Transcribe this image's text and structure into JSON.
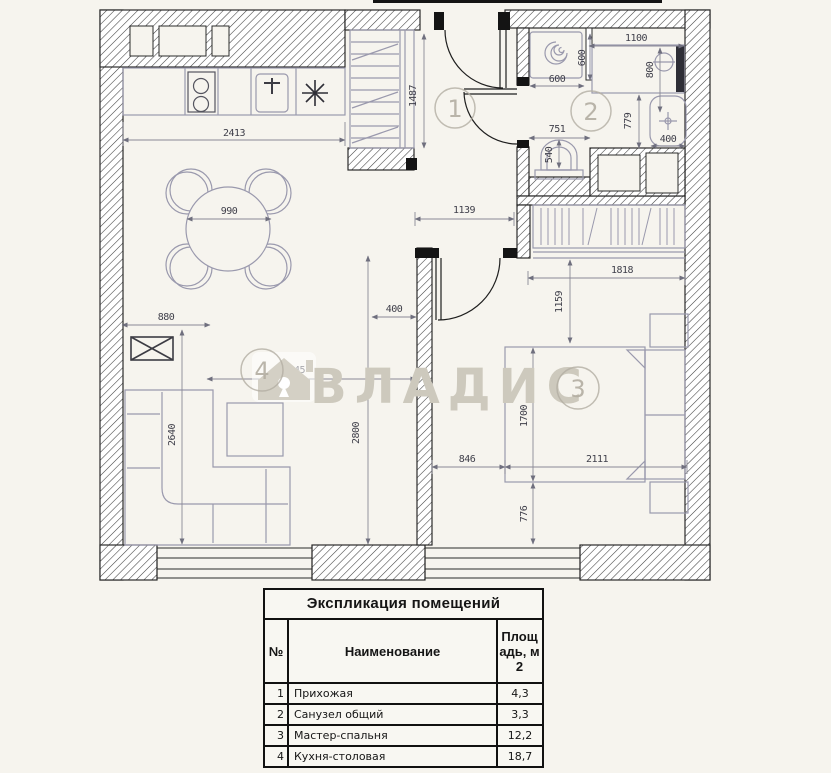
{
  "watermark": {
    "brand": "ВЛАДИС"
  },
  "icons": {
    "brand_logo": "house-keyhole-icon",
    "kitchen_vent": "asterisk-icon",
    "washer_drum": "spiral-icon"
  },
  "rooms": {
    "hallway_marker": "1",
    "bathroom_marker": "2",
    "bedroom_marker": "3",
    "kitchen_marker": "4"
  },
  "plan": {
    "dims": {
      "kitchen_counter": "2413",
      "wardrobe_depth": "1487",
      "table_diameter": "990",
      "corridor_width": "1139",
      "washer_width": "600",
      "washer_depth": "600",
      "shower_width": "1100",
      "shower_depth": "800",
      "toilet_width": "751",
      "toilet_depth": "540",
      "sink_height": "779",
      "sink_width": "400",
      "closet_width": "1818",
      "closet_offset": "1159",
      "tv_wall": "880",
      "sofa_length": "2640",
      "living_width": "2045",
      "living_length": "2800",
      "door_offset": "400",
      "bed_offset": "846",
      "bed_length": "2111",
      "bed_width": "1700",
      "bed_bottom_offset": "776"
    }
  },
  "legend_table": {
    "title": "Экспликация помещений",
    "col_num": "№",
    "col_name": "Наименование",
    "col_area": "Площадь, м2",
    "rows": [
      {
        "num": "1",
        "name": "Прихожая",
        "area": "4,3"
      },
      {
        "num": "2",
        "name": "Санузел общий",
        "area": "3,3"
      },
      {
        "num": "3",
        "name": "Мастер-спальня",
        "area": "12,2"
      },
      {
        "num": "4",
        "name": "Кухня-столовая",
        "area": "18,7"
      }
    ]
  },
  "colors": {
    "background": "#f6f4ee",
    "wall_line": "#2b2b2b",
    "furniture_line": "#9a99ad",
    "dimension_text": "#3f3f4a",
    "watermark": "#cdc9bd"
  }
}
